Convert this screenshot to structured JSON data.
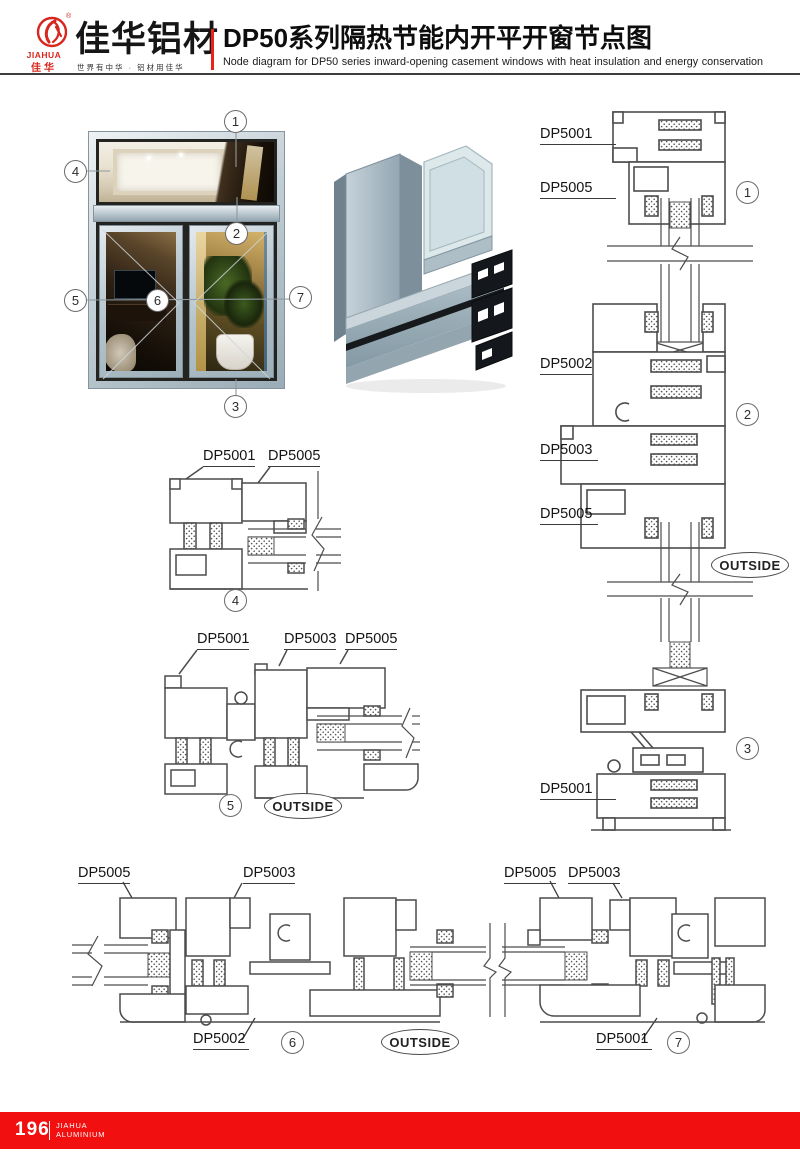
{
  "header": {
    "logo": {
      "brand_en": "JIAHUA",
      "brand_cn": "佳华",
      "registered": "®"
    },
    "company_name": "佳华铝材",
    "slogan": "世界有中华 · 铝材用佳华",
    "title_cn": "DP50系列隔热节能内开平开窗节点图",
    "title_en": "Node diagram for DP50 series inward-opening casement windows with heat insulation and energy conservation"
  },
  "overview": {
    "callouts": [
      "1",
      "2",
      "3",
      "4",
      "5",
      "6",
      "7"
    ]
  },
  "diagrams": {
    "right_section": {
      "labels": [
        "DP5001",
        "DP5005",
        "DP5002",
        "DP5003",
        "DP5005",
        "DP5001"
      ],
      "callouts": [
        "1",
        "2",
        "3"
      ],
      "outside": "OUTSIDE"
    },
    "detail_4": {
      "labels": [
        "DP5001",
        "DP5005"
      ],
      "callout": "4"
    },
    "detail_5": {
      "labels": [
        "DP5001",
        "DP5003",
        "DP5005"
      ],
      "callout": "5",
      "outside": "OUTSIDE"
    },
    "bottom_left": {
      "labels_top": [
        "DP5005",
        "DP5003"
      ],
      "label_bottom": "DP5002",
      "callout": "6",
      "outside": "OUTSIDE"
    },
    "bottom_right": {
      "labels_top": [
        "DP5005",
        "DP5003"
      ],
      "label_bottom": "DP5001",
      "callout": "7"
    }
  },
  "footer": {
    "page_number": "196",
    "brand_line1": "JIAHUA",
    "brand_line2": "ALUMINIUM"
  },
  "colors": {
    "accent_red": "#e8231a",
    "footer_red": "#f20f0f",
    "line_gray": "#4c4c4c"
  }
}
